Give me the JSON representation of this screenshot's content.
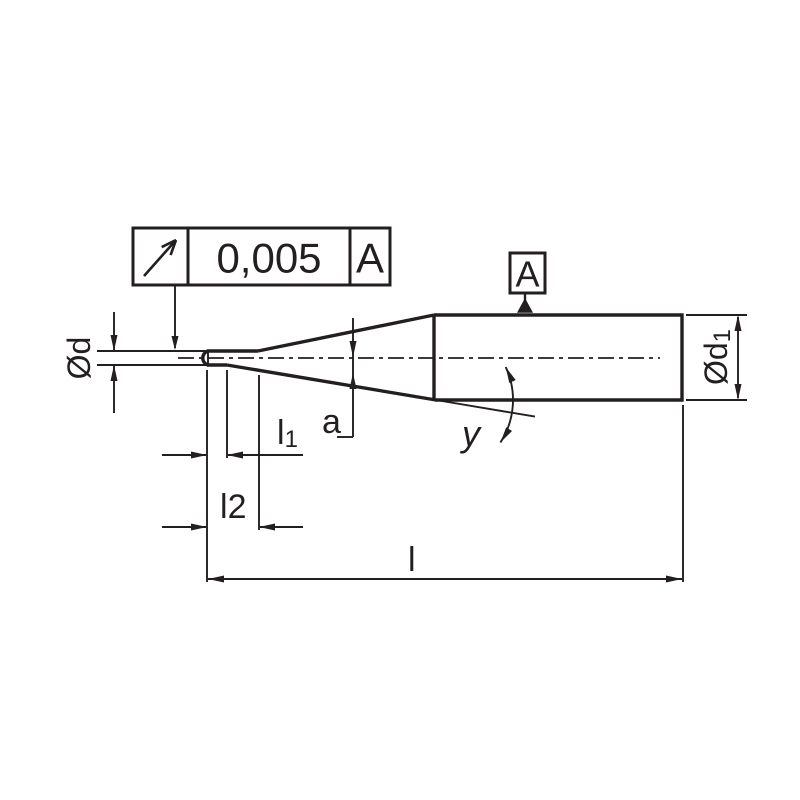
{
  "drawing": {
    "type": "technical-drawing",
    "subject": "tapered-neck ball end mill side view",
    "colors": {
      "line": "#231f20",
      "background": "#ffffff"
    },
    "tolerance_frame": {
      "symbol_icon": "circular-runout-icon",
      "value": "0,005",
      "datum_ref": "A"
    },
    "datum_feature": {
      "label": "A"
    },
    "labels": {
      "tip_diameter": "Ød",
      "shank_diameter_base": "Ød",
      "shank_diameter_sub": "1",
      "flute_length_base": "l",
      "flute_length_sub": "1",
      "neck_length_base": "l",
      "neck_length_sub": "2",
      "overall_length": "l",
      "neck_offset": "a",
      "taper_angle": "y"
    }
  }
}
